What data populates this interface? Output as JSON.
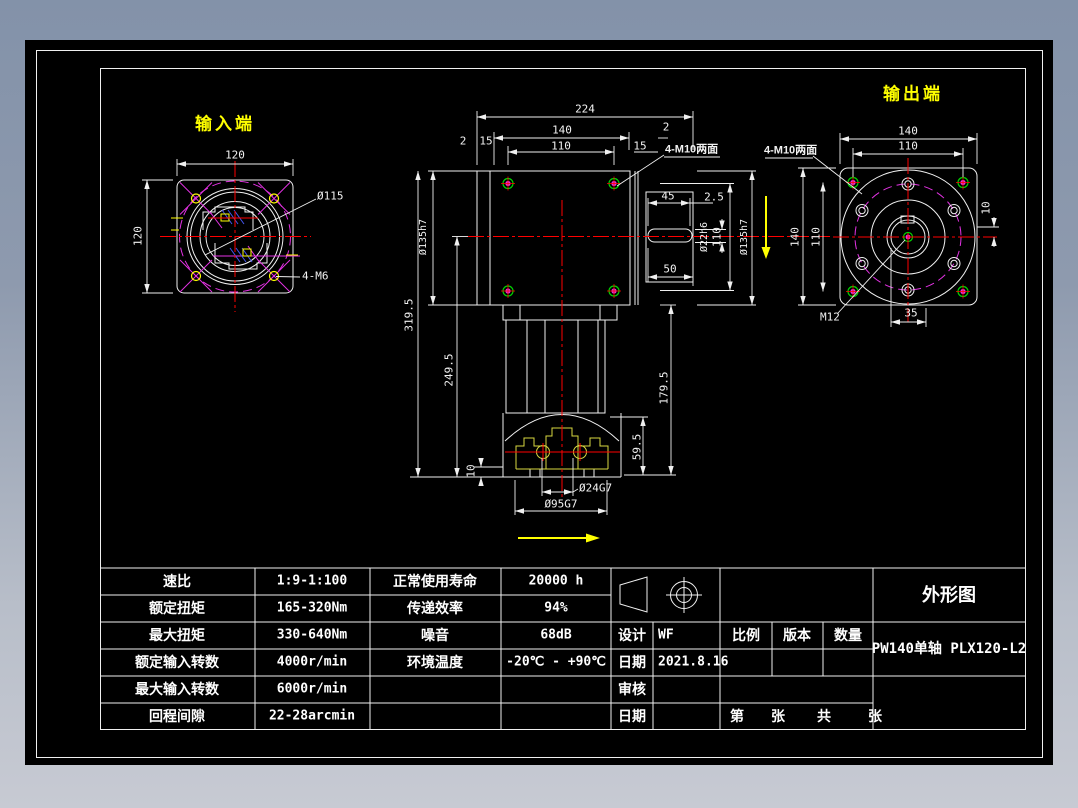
{
  "colors": {
    "canvas_bg": "#000000",
    "line_white": "#f0f0f0",
    "centerline_red": "#ff0000",
    "pitch_magenta": "#e332e3",
    "hole_green": "#00d400",
    "accent_yellow": "#ffff00",
    "clamp_yellow": "#d8d840",
    "hatch_blue": "#4455ee",
    "surround_top": "#8392a9",
    "surround_bottom": "#c7cad3"
  },
  "drawing": {
    "input_view": {
      "label": "输入端",
      "dim_width": "120",
      "dim_height": "120",
      "dim_bolt_circle": "Ø115",
      "dim_holes": "4-M6"
    },
    "main_view": {
      "dim_overall": "224",
      "dim_140": "140",
      "dim_110": "110",
      "dim_2_left": "2",
      "dim_15_left": "15",
      "dim_15_right": "15",
      "dim_2_right": "2",
      "label_holes": "4-M10两面",
      "dim_key_len": "45",
      "dim_key_off": "2.5",
      "dim_shaft": "Ø22h6",
      "dim_110_side": "110",
      "dim_flange_right": "Ø135h7",
      "dim_flange_left": "Ø135h7",
      "dim_total_height": "319.5",
      "dim_249": "249.5",
      "dim_179": "179.5",
      "dim_59": "59.5",
      "dim_10": "10",
      "dim_bore": "Ø24G7",
      "dim_spigot": "Ø95G7",
      "dim_50": "50"
    },
    "output_view": {
      "label": "输出端",
      "dim_140_top": "140",
      "dim_110_top": "110",
      "label_holes": "4-M10两面",
      "dim_140_left": "140",
      "dim_110_left": "110",
      "dim_10": "10",
      "dim_35": "35",
      "dim_thread": "M12"
    }
  },
  "spec_table": {
    "rows": [
      {
        "label": "速比",
        "value": "1:9-1:100"
      },
      {
        "label": "额定扭矩",
        "value": "165-320Nm"
      },
      {
        "label": "最大扭矩",
        "value": "330-640Nm"
      },
      {
        "label": "额定输入转数",
        "value": "4000r/min"
      },
      {
        "label": "最大输入转数",
        "value": "6000r/min"
      },
      {
        "label": "回程间隙",
        "value": "22-28arcmin"
      }
    ],
    "perf_rows": [
      {
        "label": "正常使用寿命",
        "value": "20000 h"
      },
      {
        "label": "传递效率",
        "value": "94%"
      },
      {
        "label": "噪音",
        "value": "68dB"
      },
      {
        "label": "环境温度",
        "value": "-20℃ - +90℃"
      }
    ]
  },
  "title_block": {
    "design_label": "设计",
    "design_value": "WF",
    "date_label": "日期",
    "date_value": "2021.8.16",
    "check_label": "审核",
    "date2_label": "日期",
    "scale_label": "比例",
    "version_label": "版本",
    "quantity_label": "数量",
    "sheet_no_label": "第",
    "sheet_label": "张",
    "total_label": "共",
    "total_sheet_label": "张",
    "drawing_title": "外形图",
    "model": "PW140单轴 PLX120-L2"
  }
}
